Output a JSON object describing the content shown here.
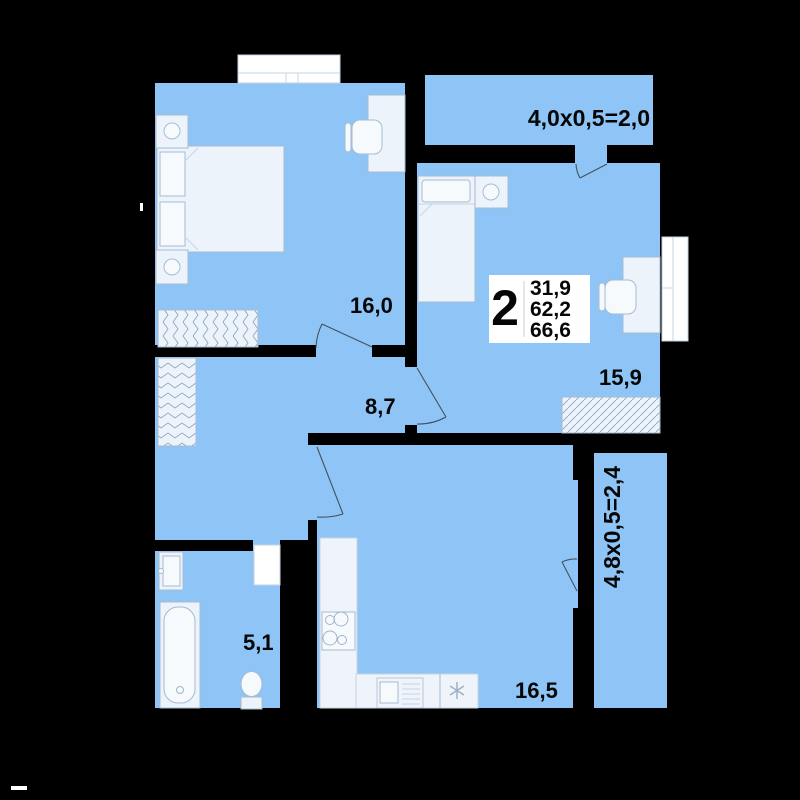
{
  "unit_info": {
    "rooms_count": "2",
    "areas": [
      "31,9",
      "62,2",
      "66,6"
    ]
  },
  "room_labels": {
    "bedroom": "16,0",
    "hallway": "8,7",
    "bedroom2": "15,9",
    "bathroom": "5,1",
    "kitchen_living": "16,5"
  },
  "balcony_labels": {
    "top": "4,0x0,5=2,0",
    "right": "4,8x0,5=2,4"
  },
  "colors": {
    "background": "#000000",
    "room_fill": "#8ec5f6",
    "furniture_fill": "#edf3fb",
    "furniture_stroke": "#a6bbd3",
    "window_fill": "#ffffff",
    "label_text": "#060606"
  }
}
